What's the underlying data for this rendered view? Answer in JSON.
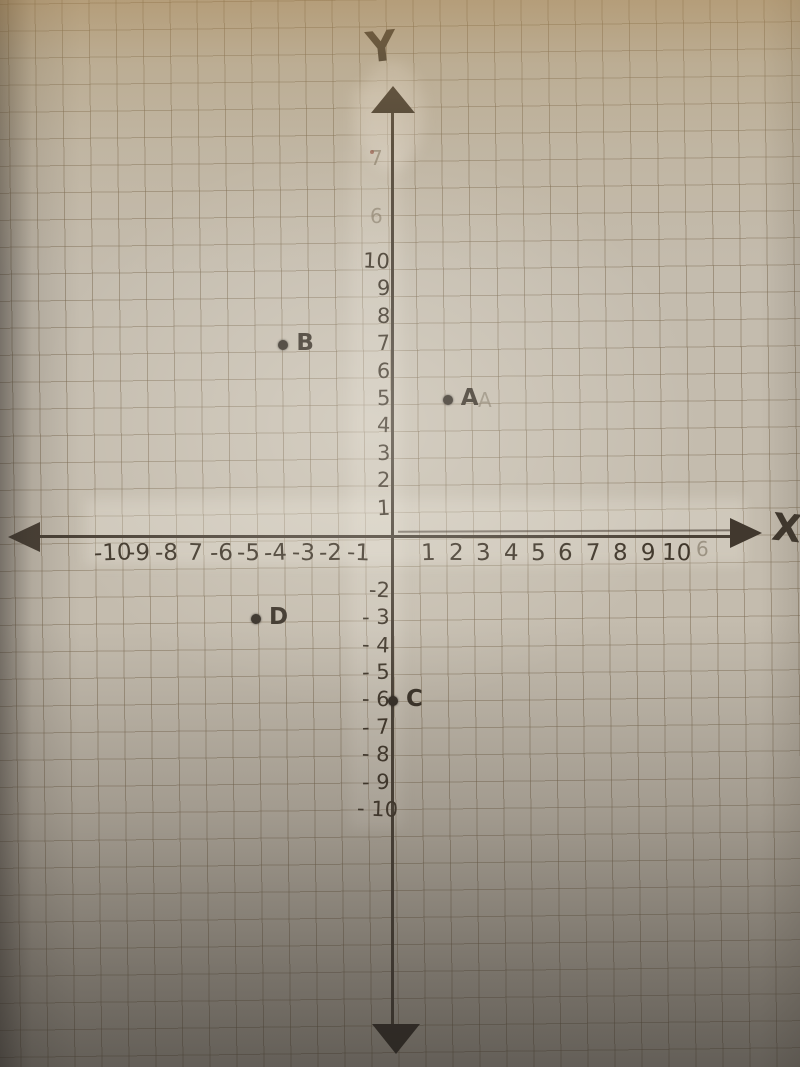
{
  "colors": {
    "ink": "#40372b",
    "paper_top": "#b3a07e",
    "paper_mid": "#c6bfb1",
    "paper_bottom": "#615c55",
    "grid_line": "#8a7c63"
  },
  "axes": {
    "x_label": "X",
    "y_label": "Y",
    "x_ticks": [
      {
        "v": -10,
        "t": "-10"
      },
      {
        "v": -9,
        "t": "-9"
      },
      {
        "v": -8,
        "t": "-8"
      },
      {
        "v": -7,
        "t": "7"
      },
      {
        "v": -6,
        "t": "-6"
      },
      {
        "v": -5,
        "t": "-5"
      },
      {
        "v": -4,
        "t": "-4"
      },
      {
        "v": -3,
        "t": "-3"
      },
      {
        "v": -2,
        "t": "-2"
      },
      {
        "v": -1,
        "t": "-1"
      },
      {
        "v": 1,
        "t": "1"
      },
      {
        "v": 2,
        "t": "2"
      },
      {
        "v": 3,
        "t": "3"
      },
      {
        "v": 4,
        "t": "4"
      },
      {
        "v": 5,
        "t": "5"
      },
      {
        "v": 6,
        "t": "6"
      },
      {
        "v": 7,
        "t": "7"
      },
      {
        "v": 8,
        "t": "8"
      },
      {
        "v": 9,
        "t": "9"
      },
      {
        "v": 10,
        "t": "10"
      }
    ],
    "y_ticks": [
      {
        "v": 10,
        "t": "10"
      },
      {
        "v": 9,
        "t": "9"
      },
      {
        "v": 8,
        "t": "8"
      },
      {
        "v": 7,
        "t": "7"
      },
      {
        "v": 6,
        "t": "6"
      },
      {
        "v": 5,
        "t": "5"
      },
      {
        "v": 4,
        "t": "4"
      },
      {
        "v": 3,
        "t": "3"
      },
      {
        "v": 2,
        "t": "2"
      },
      {
        "v": 1,
        "t": "1"
      },
      {
        "v": -2,
        "t": "-2"
      },
      {
        "v": -3,
        "t": "- 3"
      },
      {
        "v": -4,
        "t": "- 4"
      },
      {
        "v": -5,
        "t": "- 5"
      },
      {
        "v": -6,
        "t": "- 6"
      },
      {
        "v": -7,
        "t": "- 7"
      },
      {
        "v": -8,
        "t": "- 8"
      },
      {
        "v": -9,
        "t": "- 9"
      },
      {
        "v": -10,
        "t": "- 10"
      }
    ]
  },
  "points": [
    {
      "label": "A",
      "x": 2,
      "y": 5
    },
    {
      "label": "B",
      "x": -4,
      "y": 7
    },
    {
      "label": "C",
      "x": 0,
      "y": -6
    },
    {
      "label": "D",
      "x": -5,
      "y": -3
    }
  ],
  "faint_marks": [
    {
      "t": "7",
      "px": 370,
      "py": 146
    },
    {
      "t": "6",
      "px": 370,
      "py": 204
    },
    {
      "t": "6",
      "px": 696,
      "py": 537
    },
    {
      "t": "A",
      "px": 478,
      "py": 388
    }
  ],
  "chart_data": {
    "type": "scatter",
    "title": "Hand-drawn coordinate plane on graph paper with plotted points",
    "points": [
      {
        "name": "A",
        "x": 2,
        "y": 5
      },
      {
        "name": "B",
        "x": -4,
        "y": 7
      },
      {
        "name": "C",
        "x": 0,
        "y": -6
      },
      {
        "name": "D",
        "x": -5,
        "y": -3
      }
    ],
    "xlabel": "X",
    "ylabel": "Y",
    "xlim": [
      -10,
      10
    ],
    "ylim": [
      -10,
      10
    ],
    "grid": true,
    "x_tick_labels_as_written": [
      "-10",
      "-9",
      "-8",
      "7",
      "-6",
      "-5",
      "-4",
      "-3",
      "-2",
      "-1",
      "1",
      "2",
      "3",
      "4",
      "5",
      "6",
      "7",
      "8",
      "9",
      "10"
    ],
    "y_tick_labels_as_written": [
      "10",
      "9",
      "8",
      "7",
      "6",
      "5",
      "4",
      "3",
      "2",
      "1",
      "-2",
      "-3",
      "-4",
      "-5",
      "-6",
      "-7",
      "-8",
      "-9",
      "-10"
    ]
  }
}
